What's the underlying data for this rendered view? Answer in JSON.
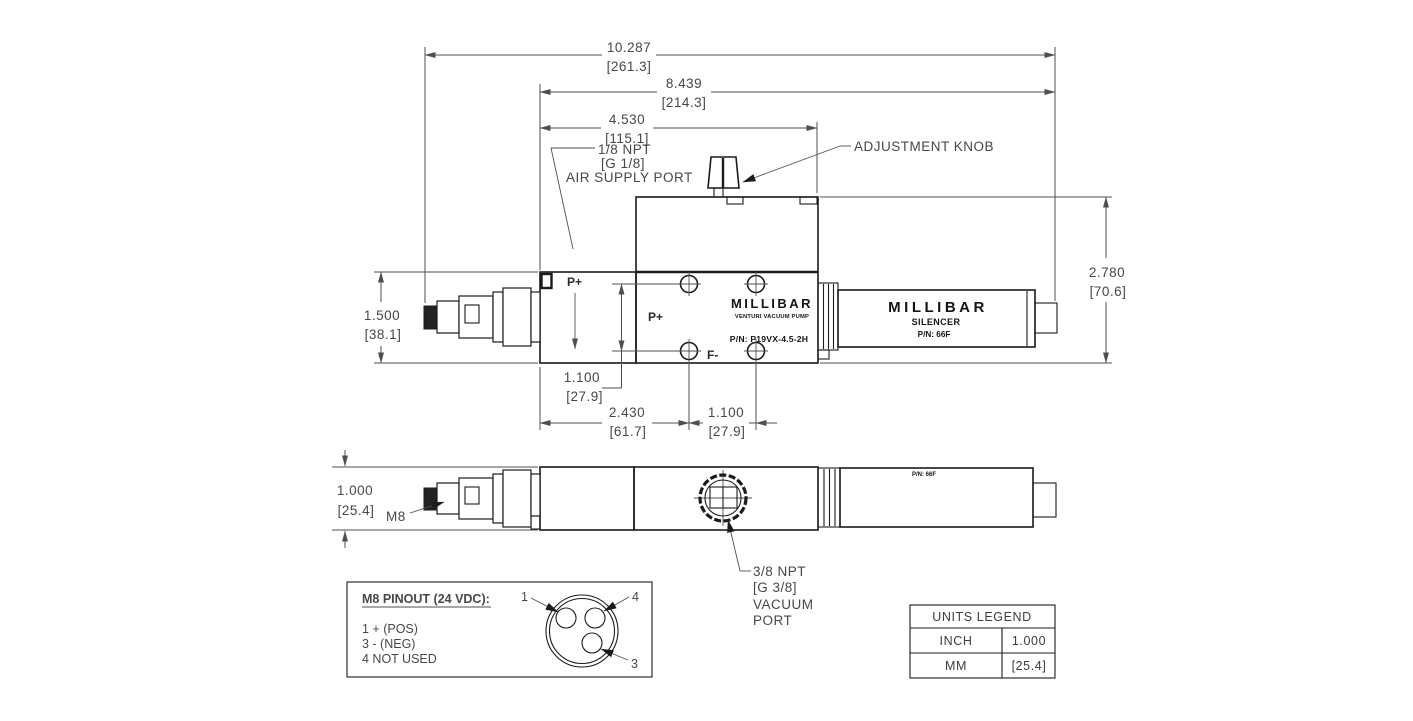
{
  "dims": {
    "overall": {
      "in": "10.287",
      "mm": "[261.3]"
    },
    "body_silencer": {
      "in": "8.439",
      "mm": "[214.3]"
    },
    "pump_width": {
      "in": "4.530",
      "mm": "[115.1]"
    },
    "valve_height": {
      "in": "1.500",
      "mm": "[38.1]"
    },
    "pump_height": {
      "in": "2.780",
      "mm": "[70.6]"
    },
    "hole_spacing_v": {
      "in": "1.100",
      "mm": "[27.9]"
    },
    "hole_offset_h": {
      "in": "2.430",
      "mm": "[61.7]"
    },
    "hole_spacing_h": {
      "in": "1.100",
      "mm": "[27.9]"
    },
    "thickness": {
      "in": "1.000",
      "mm": "[25.4]"
    }
  },
  "labels": {
    "air_supply": {
      "line1": "1/8 NPT",
      "line2": "[G 1/8]",
      "line3": "AIR SUPPLY PORT"
    },
    "adjustment_knob": "ADJUSTMENT KNOB",
    "vacuum_port": {
      "line1": "3/8 NPT",
      "line2": "[G 3/8]",
      "line3": "VACUUM",
      "line4": "PORT"
    },
    "m8": "M8",
    "p_plus_valve": "P+",
    "p_plus_pump": "P+",
    "f_minus": "F-"
  },
  "pump": {
    "brand": "MILLIBAR",
    "type": "VENTURI VACUUM PUMP",
    "part": "P/N: P19VX-4.5-2H"
  },
  "silencer": {
    "brand": "MILLIBAR",
    "name": "SILENCER",
    "part": "P/N: 66F",
    "part_side": "P/N: 66F"
  },
  "pinout": {
    "heading": "M8 PINOUT (24 VDC):",
    "line1": "1 + (POS)",
    "line2": "3 - (NEG)",
    "line3": "4 NOT USED",
    "pin1": "1",
    "pin4": "4",
    "pin3": "3"
  },
  "units_legend": {
    "title": "UNITS LEGEND",
    "row1_label": "INCH",
    "row1_value": "1.000",
    "row2_label": "MM",
    "row2_value": "[25.4]"
  },
  "colors": {
    "outline": "#1b1b1b",
    "dimension": "#4f4f4f",
    "background": "#ffffff"
  }
}
